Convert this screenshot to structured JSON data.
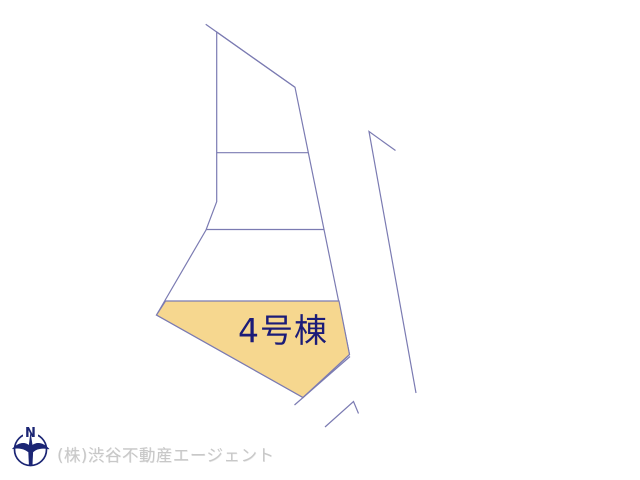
{
  "colors": {
    "line": "#7b7bb2",
    "highlight": "#f6d78f",
    "label": "#1b1b78",
    "watermark": "#c8c8c8",
    "compass": "#1b2574"
  },
  "plot_map": {
    "building_label": "4号棟",
    "geometry": {
      "outer_parcel_points": "216.7,32 295,87.3 349.5,354.5 303,397.5 156.5,315 206,230 216.7,201.7",
      "top_boundary_d": "M205.7,24.3 L295,87.3",
      "divider1_d": "M216.7,152.7 L308.5,152.7",
      "divider2_d": "M206,229.5 L324,229.5",
      "building4_points": "165.5,301 339,301 349.5,354.5 303,397.5 156.5,315",
      "road_edge_d": "M350,356.5 L294.5,405",
      "corner_mark_d": "M325,427 L353.5,401.5 L358.5,413.5",
      "right_road_d": "M395.5,150.5 L369,131.5 L416,393"
    }
  },
  "compass": {
    "north_label": "N"
  },
  "watermark": {
    "text": "(株)渋谷不動産エージェント"
  }
}
